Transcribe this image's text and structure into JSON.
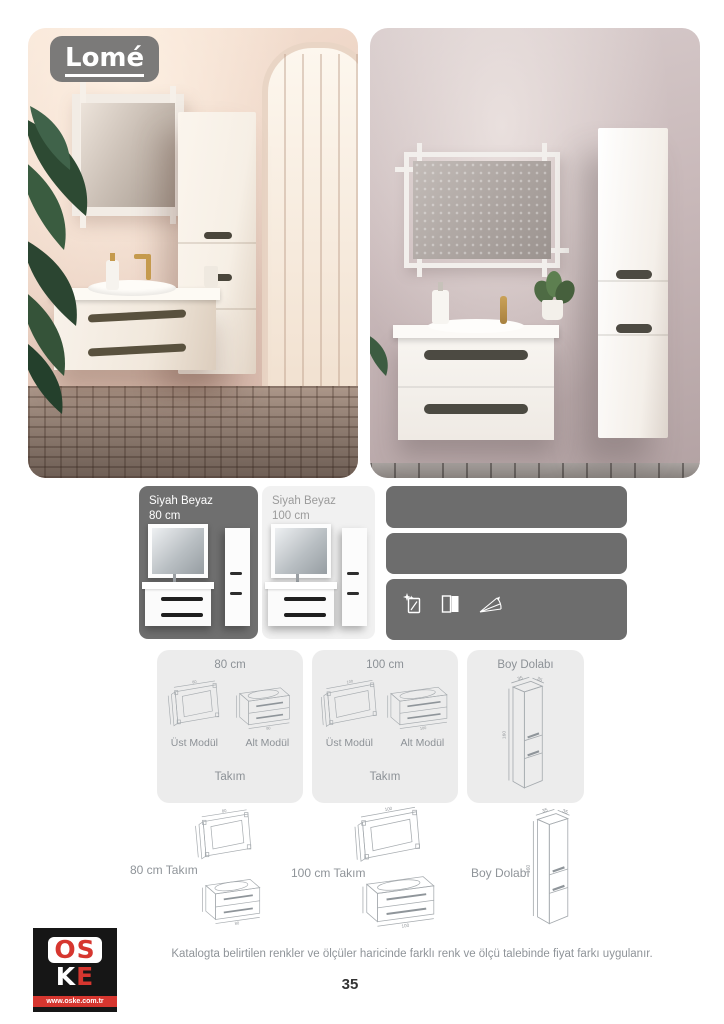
{
  "badge": {
    "label": "Lomé"
  },
  "variants": {
    "v80": {
      "line1": "Siyah Beyaz",
      "line2": "80 cm"
    },
    "v100": {
      "line1": "Siyah Beyaz",
      "line2": "100 cm"
    }
  },
  "features": {
    "icons": [
      "mirror-sparkle-icon",
      "cabinet-door-icon",
      "soft-close-icon"
    ]
  },
  "spec_cards": {
    "c80": {
      "title": "80 cm",
      "top_module": "Üst Modül",
      "bottom_module": "Alt Modül",
      "set": "Takım",
      "width_dim": "80"
    },
    "c100": {
      "title": "100 cm",
      "top_module": "Üst Modül",
      "bottom_module": "Alt Modül",
      "set": "Takım",
      "width_dim": "100"
    },
    "boy": {
      "title": "Boy Dolabı",
      "width_dim": "35",
      "depth_dim": "35",
      "height_dim": "160"
    }
  },
  "bottom_row": {
    "set80": {
      "label": "80 cm Takım",
      "width_dim": "80"
    },
    "set100": {
      "label": "100 cm Takım",
      "width_dim": "100"
    },
    "boy": {
      "label": "Boy Dolabı",
      "width_dim": "35",
      "depth_dim": "35",
      "height_dim": "160"
    }
  },
  "footer": {
    "disclaimer": "Katalogta belirtilen renkler ve ölçüler haricinde farklı renk ve ölçü talebinde fiyat farkı uygulanır.",
    "page_number": "35"
  },
  "logo": {
    "top": "OS",
    "k": "K",
    "e": "E",
    "url": "www.oske.com.tr"
  },
  "colors": {
    "box_gray": "#6d6d6d",
    "card_gray": "#ececec",
    "logo_red": "#d6362f",
    "logo_black": "#161616",
    "text_gray": "#8f9499"
  }
}
